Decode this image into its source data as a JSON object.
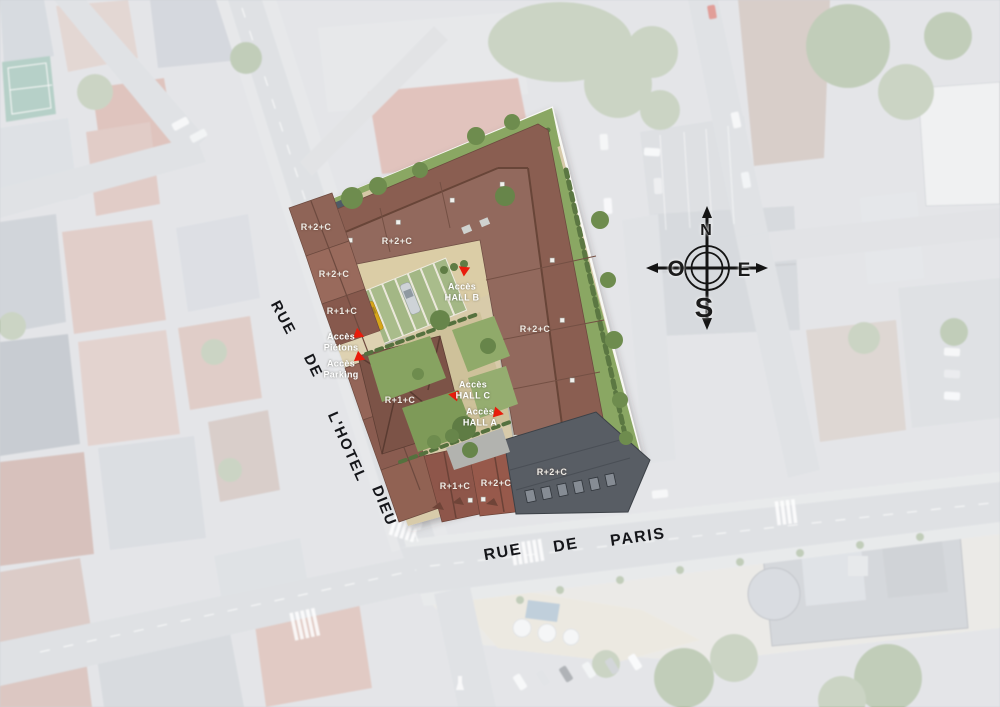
{
  "map": {
    "streets": {
      "rue_hotel_dieu": {
        "name": "RUE DE L'HOTEL DIEU",
        "words": [
          "RUE",
          "DE",
          "L'HOTEL",
          "DIEU"
        ]
      },
      "rue_de_paris": {
        "name": "RUE DE PARIS",
        "words": [
          "RUE",
          "DE",
          "PARIS"
        ]
      }
    },
    "compass": {
      "north": "N",
      "west": "O",
      "east": "E",
      "south": "S"
    },
    "site_plan": {
      "building_levels": [
        {
          "text": "R+2+C"
        },
        {
          "text": "R+2+C"
        },
        {
          "text": "R+2+C"
        },
        {
          "text": "R+1+C"
        },
        {
          "text": "R+2+C"
        },
        {
          "text": "R+1+C"
        },
        {
          "text": "R+1+C"
        },
        {
          "text": "R+2+C"
        },
        {
          "text": "R+2+C"
        }
      ],
      "access_points": [
        {
          "line1": "Accès",
          "line2": "Piétons"
        },
        {
          "line1": "Accès",
          "line2": "Parking"
        },
        {
          "line1": "Accès",
          "line2": "HALL B"
        },
        {
          "line1": "Accès",
          "line2": "HALL C"
        },
        {
          "line1": "Accès",
          "line2": "HALL A"
        }
      ]
    },
    "colors": {
      "accent_red": "#e81c0c",
      "roof_brown": "#8a5e51",
      "roof_dark_gray": "#585d64",
      "lawn_green": "#8aa763",
      "court_beige": "#dbcda6"
    }
  }
}
